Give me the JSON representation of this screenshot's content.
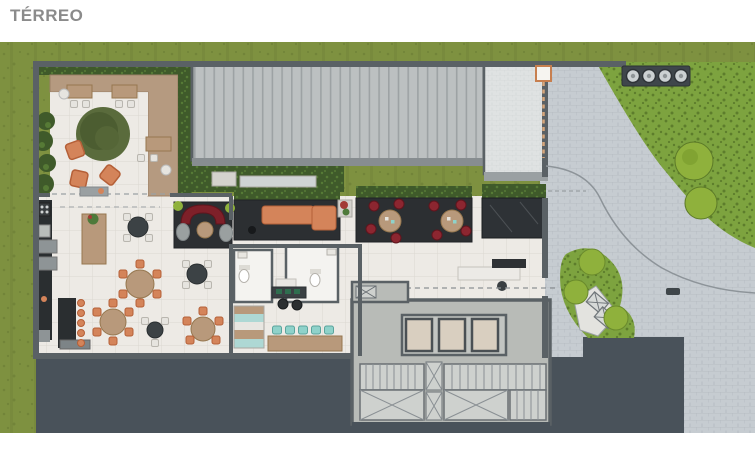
{
  "page": {
    "title": "TÉRREO"
  },
  "counts": {
    "waste_enclosure_bins": 4,
    "elevators": 3,
    "desk_teal_chairs": 5,
    "bar_stools": 5
  },
  "palette": {
    "page_bg": "#ffffff",
    "title_color": "#8b8b8b",
    "grass": "#7e9140",
    "grass_dark": "#6d7f36",
    "shrub": "#7da33f",
    "shrub_dark": "#5d7d2c",
    "tree_bright": "#8fb13c",
    "hedge": "#3f5a2a",
    "hedge_light": "#567a36",
    "paver": "#c6ccd1",
    "paver_line": "#b4bac0",
    "walkway": "#dfe2e2",
    "roof_rib_bg": "#bcc0c1",
    "roof_rib_line": "#9da2a4",
    "tile": "#edeae5",
    "tile_line": "#dcd8d1",
    "deck": "#b59a80",
    "wall": "#5a6165",
    "slab": "#49525a",
    "marble": "#2c2f32",
    "concrete": "#b8bbb7",
    "elevator": "#d9cfc0",
    "stair": "#ced1ce",
    "orange": "#d4845a",
    "orange_dark": "#b56038",
    "wood": "#b8997b",
    "wood_dark": "#96774f",
    "red_seat": "#8c2630",
    "red_sofa": "#7e2029",
    "teal_seat": "#8fd2ca",
    "white_chair": "#e6e4df",
    "dark_counter": "#2a2e30",
    "gate_orange": "#c77f4f"
  }
}
